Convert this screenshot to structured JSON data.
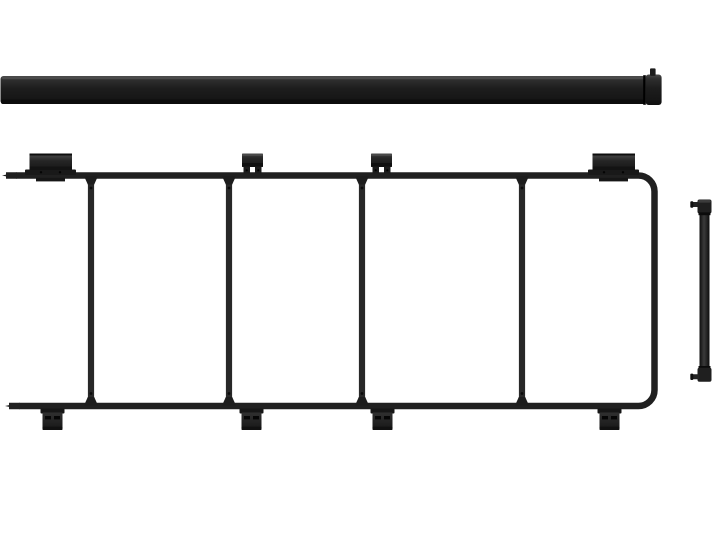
{
  "canvas": {
    "width": 720,
    "height": 539
  },
  "colors": {
    "page-bg": "#ffffff",
    "ink": "#202020",
    "ink-dark": "#0e0e0e",
    "ink-mid": "#282828",
    "ink-light": "#454545",
    "bracket-fill": "#1a1a1a",
    "slot-dark": "#060606"
  },
  "illustration": {
    "kind": "product-image",
    "parts": [
      "load-bar",
      "rack-frame-with-mounting-brackets",
      "tie-down-bar"
    ]
  }
}
